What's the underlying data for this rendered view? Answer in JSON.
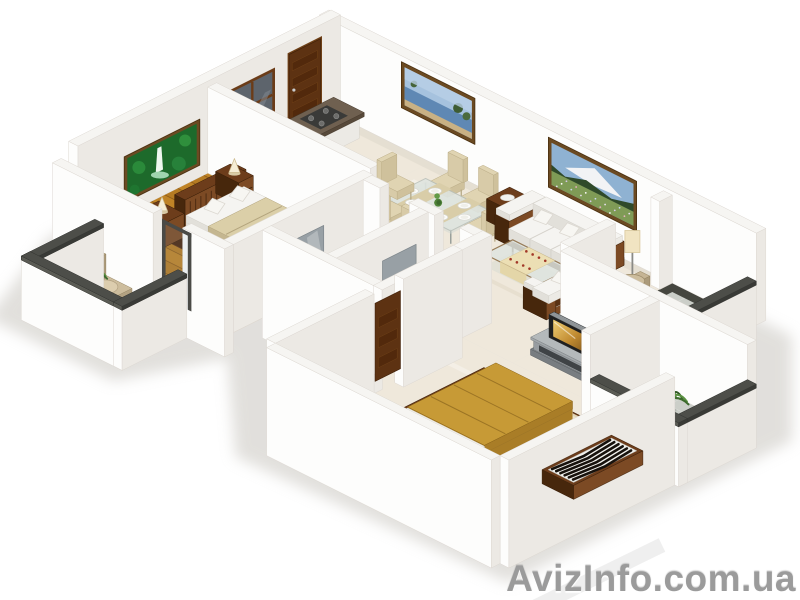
{
  "watermark": {
    "text": "AvizInfo.com.ua"
  },
  "scene": {
    "description": "3D isometric render of a two-bedroom apartment floor plan, white walls, viewed from above at an angle",
    "rooms": [
      {
        "name": "bedroom-1",
        "floor": "wood-planks",
        "furniture": [
          "waterfall-wall-art",
          "double-bed-beige",
          "slatted-headboard",
          "nightstand-left",
          "nightstand-right",
          "cone-table-lamps",
          "dark-area-rug",
          "wardrobe",
          "zebra-bench"
        ]
      },
      {
        "name": "kitchen",
        "floor": "marble",
        "furniture": [
          "entry-door",
          "window",
          "l-shaped-counter",
          "cooktop",
          "sink",
          "kettle",
          "red-bowl"
        ]
      },
      {
        "name": "dining-area",
        "floor": "marble",
        "furniture": [
          "glass-dining-table",
          "dining-chairs-x6",
          "white-plates",
          "table-runners",
          "green-centerpiece"
        ]
      },
      {
        "name": "living-room",
        "floor": "marble",
        "furniture": [
          "lake-wall-art",
          "mountain-meadow-wall-art",
          "three-seat-sofa",
          "loveseat",
          "side-table",
          "coffee-table",
          "dotted-table-runner",
          "floor-lamp"
        ]
      },
      {
        "name": "bathroom-1",
        "floor": "blue-tile",
        "furniture": [
          "wood-vanity-basin",
          "toilet",
          "mirror"
        ]
      },
      {
        "name": "bathroom-2",
        "floor": "blue-tile",
        "furniture": [
          "wood-vanity-basin",
          "toilet",
          "mirror"
        ]
      },
      {
        "name": "bedroom-2",
        "floor": "marble-with-shag-rug",
        "furniture": [
          "gold-double-bed",
          "wood-platform",
          "white-headboard",
          "nightstands-with-candle-lamps",
          "tv-media-stand",
          "television",
          "zebra-bench",
          "entry-door-panel"
        ]
      },
      {
        "name": "balcony-left",
        "floor": "gray-tile-dark-border",
        "furniture": [
          "wicker-chair",
          "potted-palm",
          "potted-palm"
        ]
      },
      {
        "name": "balcony-right",
        "floor": "gray-tile-dark-border",
        "furniture": [
          "wicker-chair",
          "potted-palm",
          "potted-palm"
        ]
      },
      {
        "name": "balcony-bottom-right",
        "floor": "gray-tile-dark-border",
        "furniture": [
          "potted-palm",
          "potted-palm",
          "potted-palm"
        ]
      }
    ],
    "palette": {
      "wall_top": "#f6f5f2",
      "wall_se": "#ece9e4",
      "wall_sw": "#fdfdfc",
      "wall_stroke": "#ddd8d2",
      "marble": "#efe8db",
      "marble_vein": "#e0d6c4",
      "wood_floor": "#bf8326",
      "wood_line": "#6b3a10",
      "dark_wood": "#5f3416",
      "dark_wood_hi": "#7c4a24",
      "dark_wood_lo": "#47270c",
      "beige_blanket": "#dbcfa8",
      "gold_blanket": "#c4952f",
      "tile_blue": "#a9bdd6",
      "balcony_floor": "#cbcec8",
      "balcony_border": "#45463f",
      "parapet_cap": "#4d4e49",
      "white_top": "#f5f4f1",
      "white_se": "#eceae5",
      "white_sw": "#e2e0da",
      "chair_beige": "#dfd3b2",
      "glass": "#dfe5e0",
      "tv_gray": "#a9aeb1",
      "screen_gold": "#c89a3c",
      "plant_green": "#4f8338",
      "accent_red": "#a23828",
      "mirror_gray": "#98a0a5",
      "shag_rug": "#ede3c9",
      "watermark_gray": "#9b9b9b"
    }
  }
}
